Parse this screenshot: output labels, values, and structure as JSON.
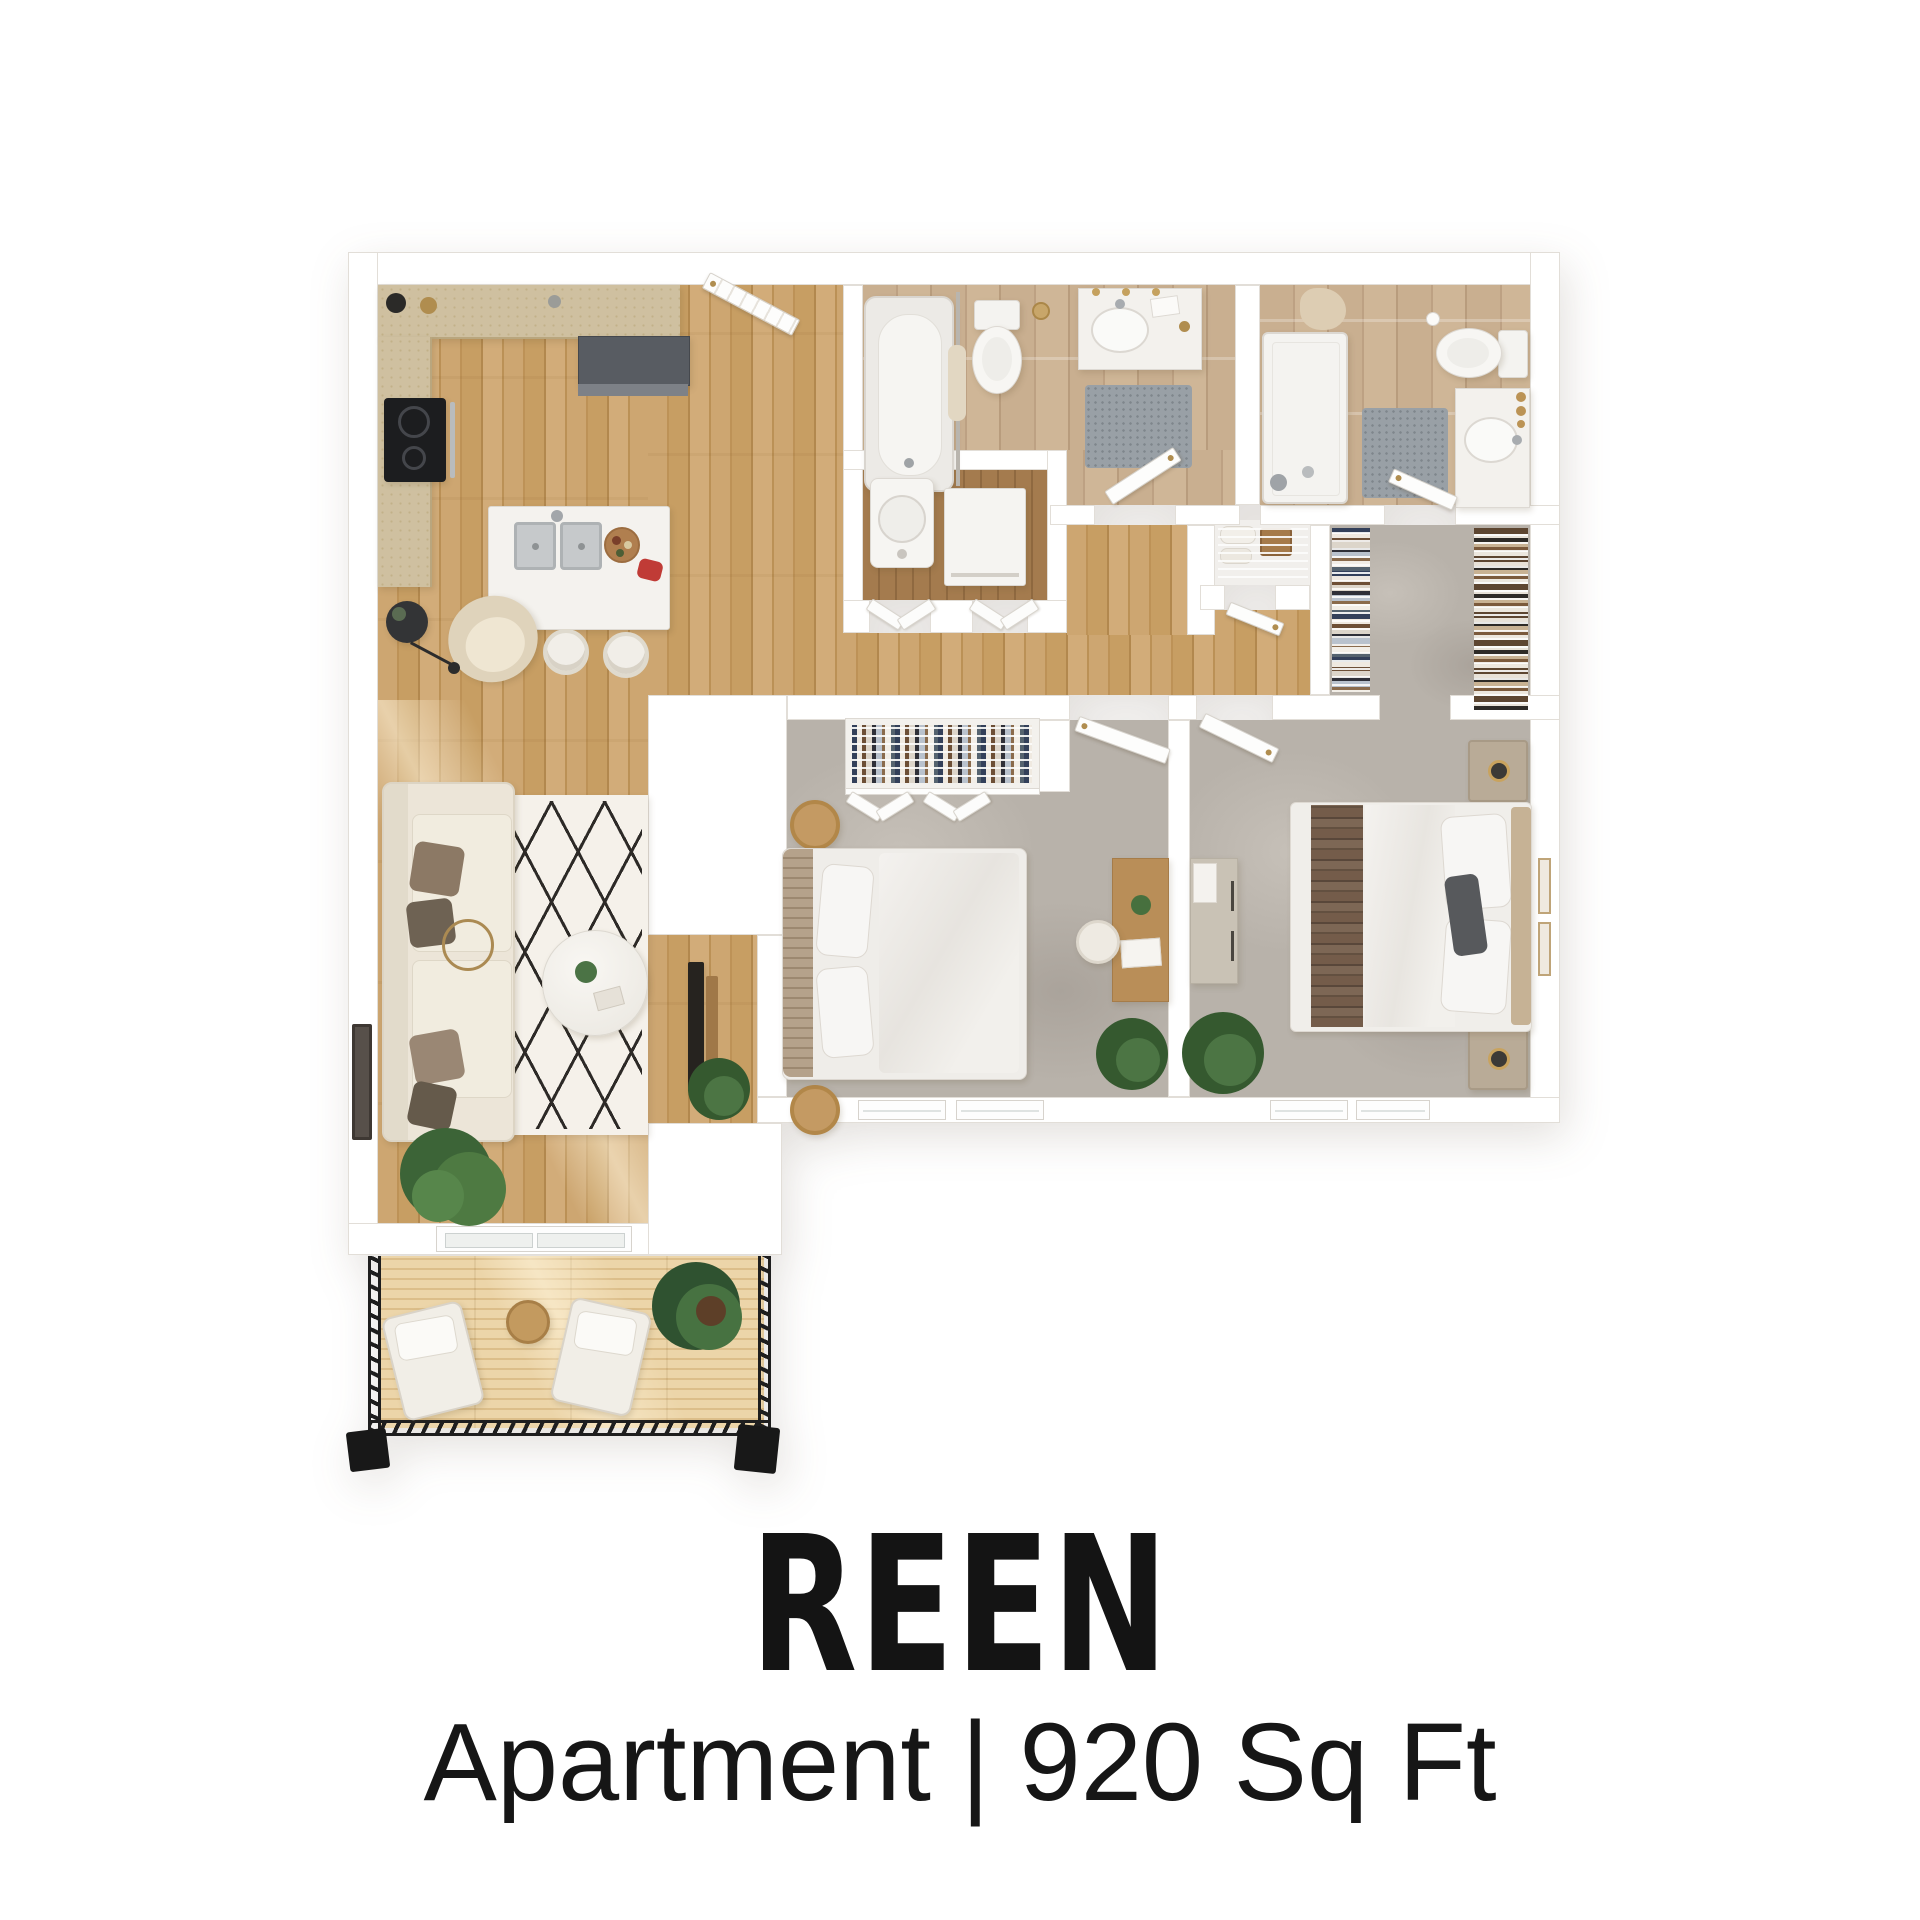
{
  "caption": {
    "title": "REEN",
    "subtitle": {
      "type": "Apartment",
      "separator": "|",
      "area": "920 Sq Ft"
    }
  },
  "plan": {
    "rooms": [
      {
        "id": "kitchen",
        "label": "Kitchen",
        "floor": "wood"
      },
      {
        "id": "entry",
        "label": "Entry",
        "floor": "wood"
      },
      {
        "id": "living-room",
        "label": "Living Room",
        "floor": "wood"
      },
      {
        "id": "hallway",
        "label": "Hallway",
        "floor": "wood"
      },
      {
        "id": "main-bathroom",
        "label": "Main Bathroom",
        "floor": "tile"
      },
      {
        "id": "ensuite-bathroom",
        "label": "Ensuite Bathroom",
        "floor": "tile"
      },
      {
        "id": "laundry-closet",
        "label": "Laundry Closet",
        "floor": "wood"
      },
      {
        "id": "linen-closet",
        "label": "Linen Closet",
        "floor": "white"
      },
      {
        "id": "walk-in-closet",
        "label": "Walk-in Closet",
        "floor": "carpet"
      },
      {
        "id": "bedroom-1",
        "label": "Bedroom 1",
        "floor": "carpet"
      },
      {
        "id": "master-bedroom",
        "label": "Master Bedroom",
        "floor": "carpet"
      },
      {
        "id": "balcony",
        "label": "Balcony",
        "floor": "deck"
      }
    ],
    "palette": {
      "wall": "#ffffff",
      "wood_floor": "#c8a06a",
      "deck_floor": "#e6cc9d",
      "tile_floor": "#c6ab8b",
      "carpet_floor": "#b7b1aa",
      "railing": "#1e1e1e",
      "accent_gold": "#b08d4f",
      "text": "#151515"
    }
  }
}
